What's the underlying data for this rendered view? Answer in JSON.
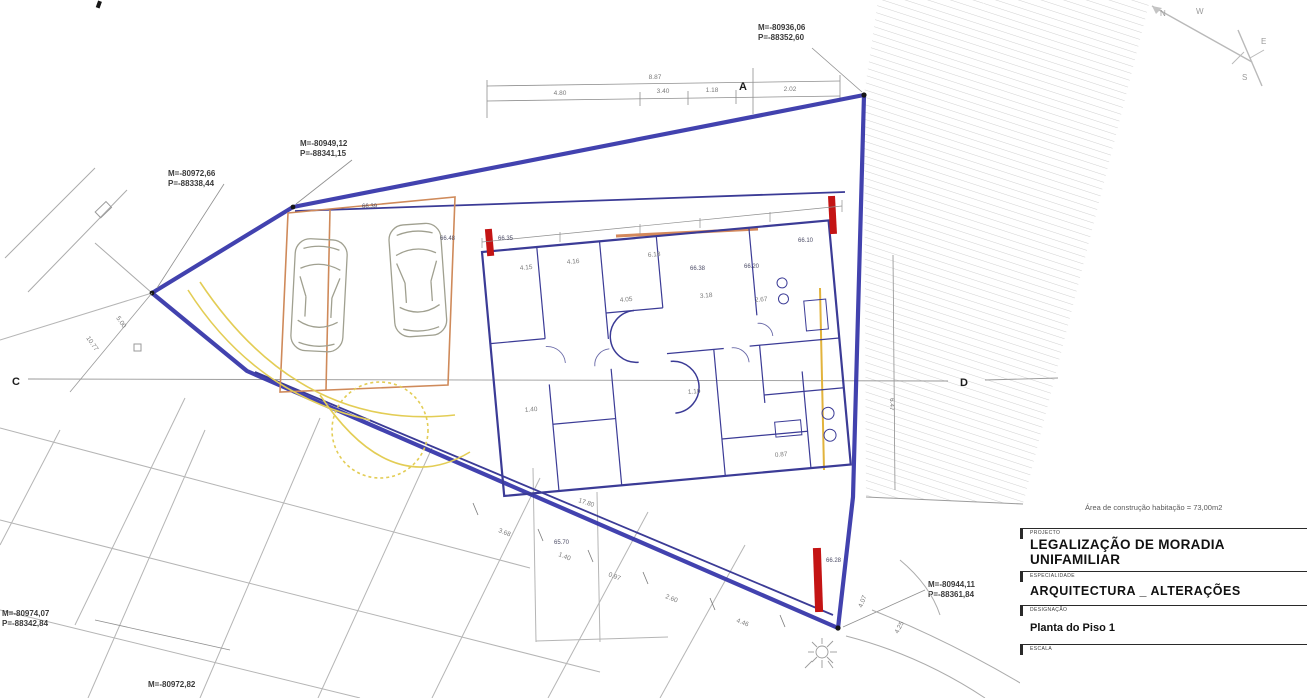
{
  "drawing": {
    "note": "Área de construção habitação = 73,00m2",
    "coordinates": {
      "top_right": {
        "m": "M=-80936,06",
        "p": "P=-88352,60"
      },
      "upper_mid": {
        "m": "M=-80949,12",
        "p": "P=-88341,15"
      },
      "left": {
        "m": "M=-80972,66",
        "p": "P=-88338,44"
      },
      "bottom_right": {
        "m": "M=-80944,11",
        "p": "P=-88361,84"
      },
      "bottom_left": {
        "m": "M=-80974,07",
        "p": "P=-88342,84"
      },
      "bottom_edge": {
        "m": "M=-80972,82"
      }
    },
    "section_markers": {
      "a": "A",
      "c": "C",
      "d": "D"
    },
    "compass": {
      "n": "N",
      "e": "E",
      "s": "S",
      "w": "W"
    },
    "dimensions": {
      "top_total": "8.87",
      "top_segments": [
        "4.80",
        "3.40",
        "1.18",
        "2.02"
      ],
      "right_side": "6.47",
      "left_side": [
        "10.77",
        "5.00"
      ],
      "bottom_chain": [
        "3.68",
        "1.40",
        "0.97",
        "2.60",
        "4.46"
      ],
      "lower_right": [
        "4.07",
        "4.25"
      ],
      "interior": [
        "4.15",
        "4.16",
        "6.18",
        "3.18",
        "2.67",
        "1.40",
        "4.05",
        "1.10",
        "0.87",
        "17.80"
      ]
    },
    "levels": [
      "66.39",
      "66.48",
      "66.35",
      "66.10",
      "66.20",
      "66.38",
      "66.28",
      "65.70"
    ]
  },
  "title_block": {
    "project_label": "PROJECTO",
    "project_title_line1": "LEGALIZAÇÃO DE MORADIA",
    "project_title_line2": "UNIFAMILIAR",
    "specialty_label": "ESPECIALIDADE",
    "specialty": "ARQUITECTURA _ ALTERAÇÕES",
    "designation_label": "DESIGNAÇÃO",
    "designation": "Planta do Piso 1",
    "scale_label": "ESCALA"
  }
}
